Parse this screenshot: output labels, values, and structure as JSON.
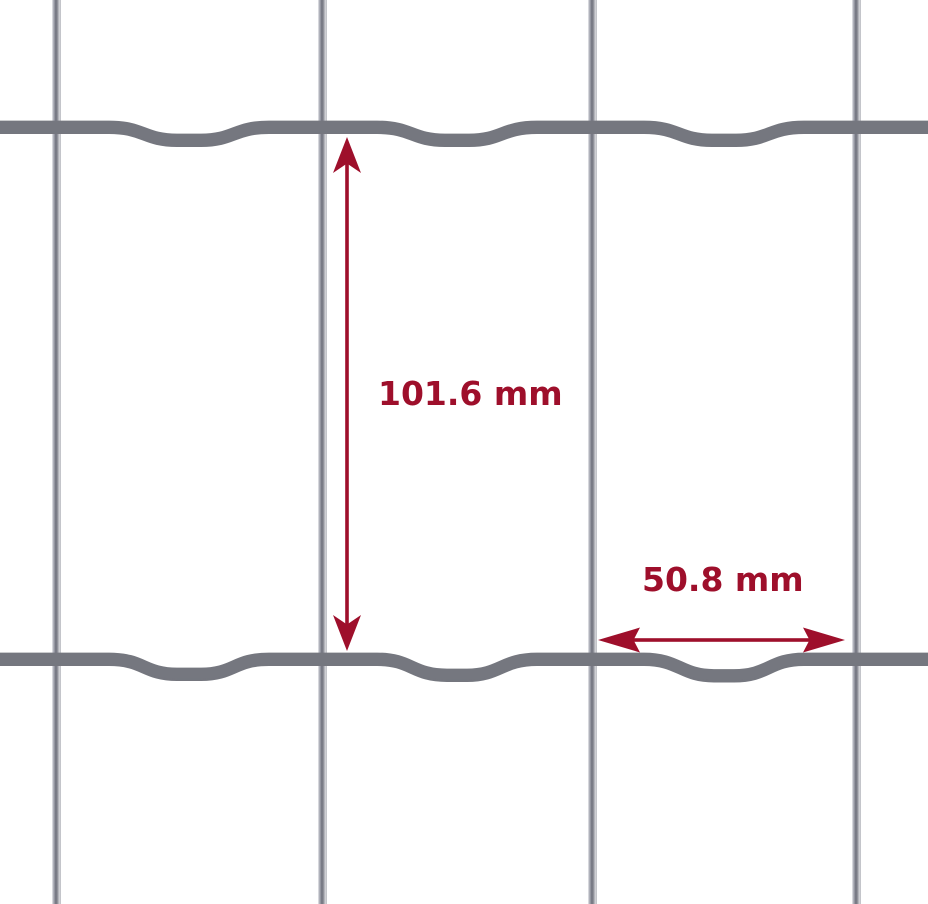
{
  "diagram": {
    "kind": "welded-wire-mesh-dimension-diagram",
    "dimensions": {
      "vertical": {
        "label": "101.6 mm",
        "value": 101.6,
        "unit": "mm"
      },
      "horizontal": {
        "label": "50.8 mm",
        "value": 50.8,
        "unit": "mm"
      }
    },
    "mesh": {
      "vertical_wire_count": 4,
      "horizontal_wire_count": 2,
      "opening_height_mm": 101.6,
      "opening_width_mm": 50.8
    },
    "colors": {
      "dimension_red": "#9e0f2b",
      "background": "#ffffff",
      "wire_dark": "#70727d",
      "wire_mid": "#9a9ca4",
      "wire_light": "#d4d5d9"
    }
  }
}
